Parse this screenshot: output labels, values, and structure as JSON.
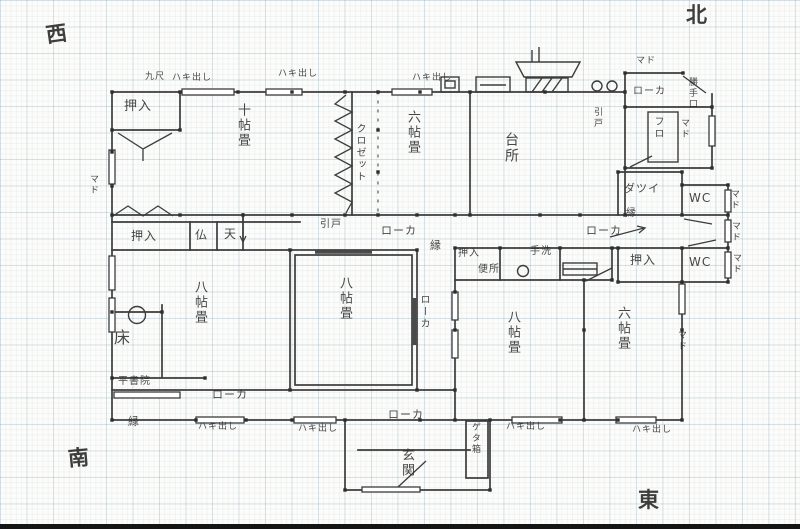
{
  "compass": {
    "west": "西",
    "north": "北",
    "south": "南",
    "east": "東"
  },
  "rooms": {
    "ten_mat": "十帖畳",
    "six_mat_north": "六帖畳",
    "closet_strip": "クロゼット",
    "kitchen": "台所",
    "eight_mat_west": "八帖畳",
    "eight_mat_middle": "八帖畳",
    "eight_mat_south": "八帖畳",
    "six_mat_south": "六帖畳",
    "genkan": "玄関",
    "bath": "フロ",
    "changing": "ダツイ",
    "wc": "WC",
    "toilet": "便所",
    "tearai": "手洗",
    "tokonoma": "床",
    "shoin": "平書院",
    "butsudan": "仏",
    "tenbukuro": "天",
    "getabako": "ゲタ箱"
  },
  "fittings": {
    "oshiire": "押入"
  },
  "circulation": {
    "roka": "ローカ",
    "en": "縁"
  },
  "openings": {
    "mado": "マド",
    "hakidashi": "ハキ出し",
    "hikido": "引戸",
    "katteguchi": "勝手口",
    "kyushaku": "九尺"
  }
}
